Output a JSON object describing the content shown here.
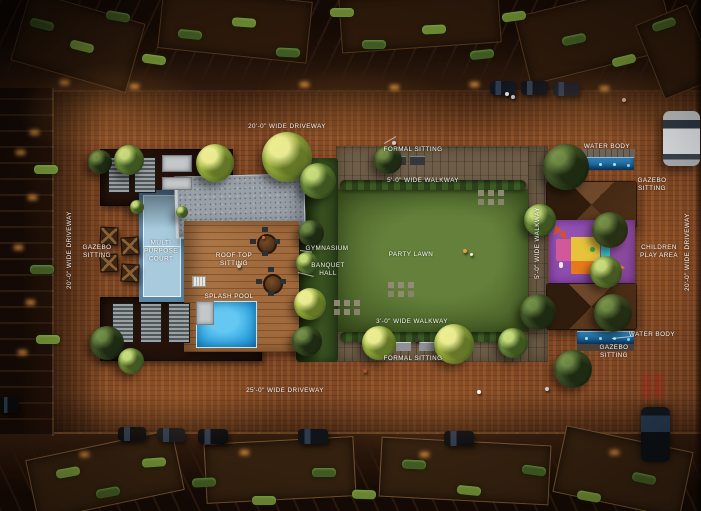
{
  "scene": {
    "description": "Aerial night rendering of a residential complex amenity courtyard"
  },
  "labels": {
    "driveway_top": "20'-0\" WIDE DRIVEWAY",
    "driveway_bottom": "25'-0\" WIDE DRIVEWAY",
    "driveway_left": "20'-0\" WIDE DRIVEWAY",
    "driveway_right": "20'-0\" WIDE DRIVEWAY",
    "walkway_top": "5'-0\" WIDE WALKWAY",
    "walkway_bottom": "3'-0\" WIDE WALKWAY",
    "walkway_right": "5'-0\" WIDE WALKWAY",
    "formal_sitting_top": "FORMAL SITTING",
    "formal_sitting_bottom": "FORMAL SITTING",
    "water_body_top": "WATER BODY",
    "water_body_bottom": "WATER BODY",
    "gazebo_sitting_left": "GAZEBO SITTING",
    "gazebo_sitting_top_right": "GAZEBO SITTING",
    "gazebo_sitting_bottom_right": "GAZEBO SITTING",
    "multi_purpose_court": "MULTI PURPOSE COURT",
    "roof_top_sitting": "ROOF TOP SITTING",
    "splash_pool": "SPLASH POOL",
    "gymnasium": "GYMNASIUM",
    "banquet_hall": "BANQUET HALL",
    "party_lawn": "PARTY LAWN",
    "children_play_area": "CHILDREN PLAY AREA"
  },
  "colors": {
    "brick_paving": "#7c4523",
    "lawn": "#5a7434",
    "splash_pool": "#35aae6",
    "water_body": "#155a8e",
    "sport_court": "#a6cadd",
    "play_mat": "#8e4cae",
    "label_text": "#ffffff"
  }
}
